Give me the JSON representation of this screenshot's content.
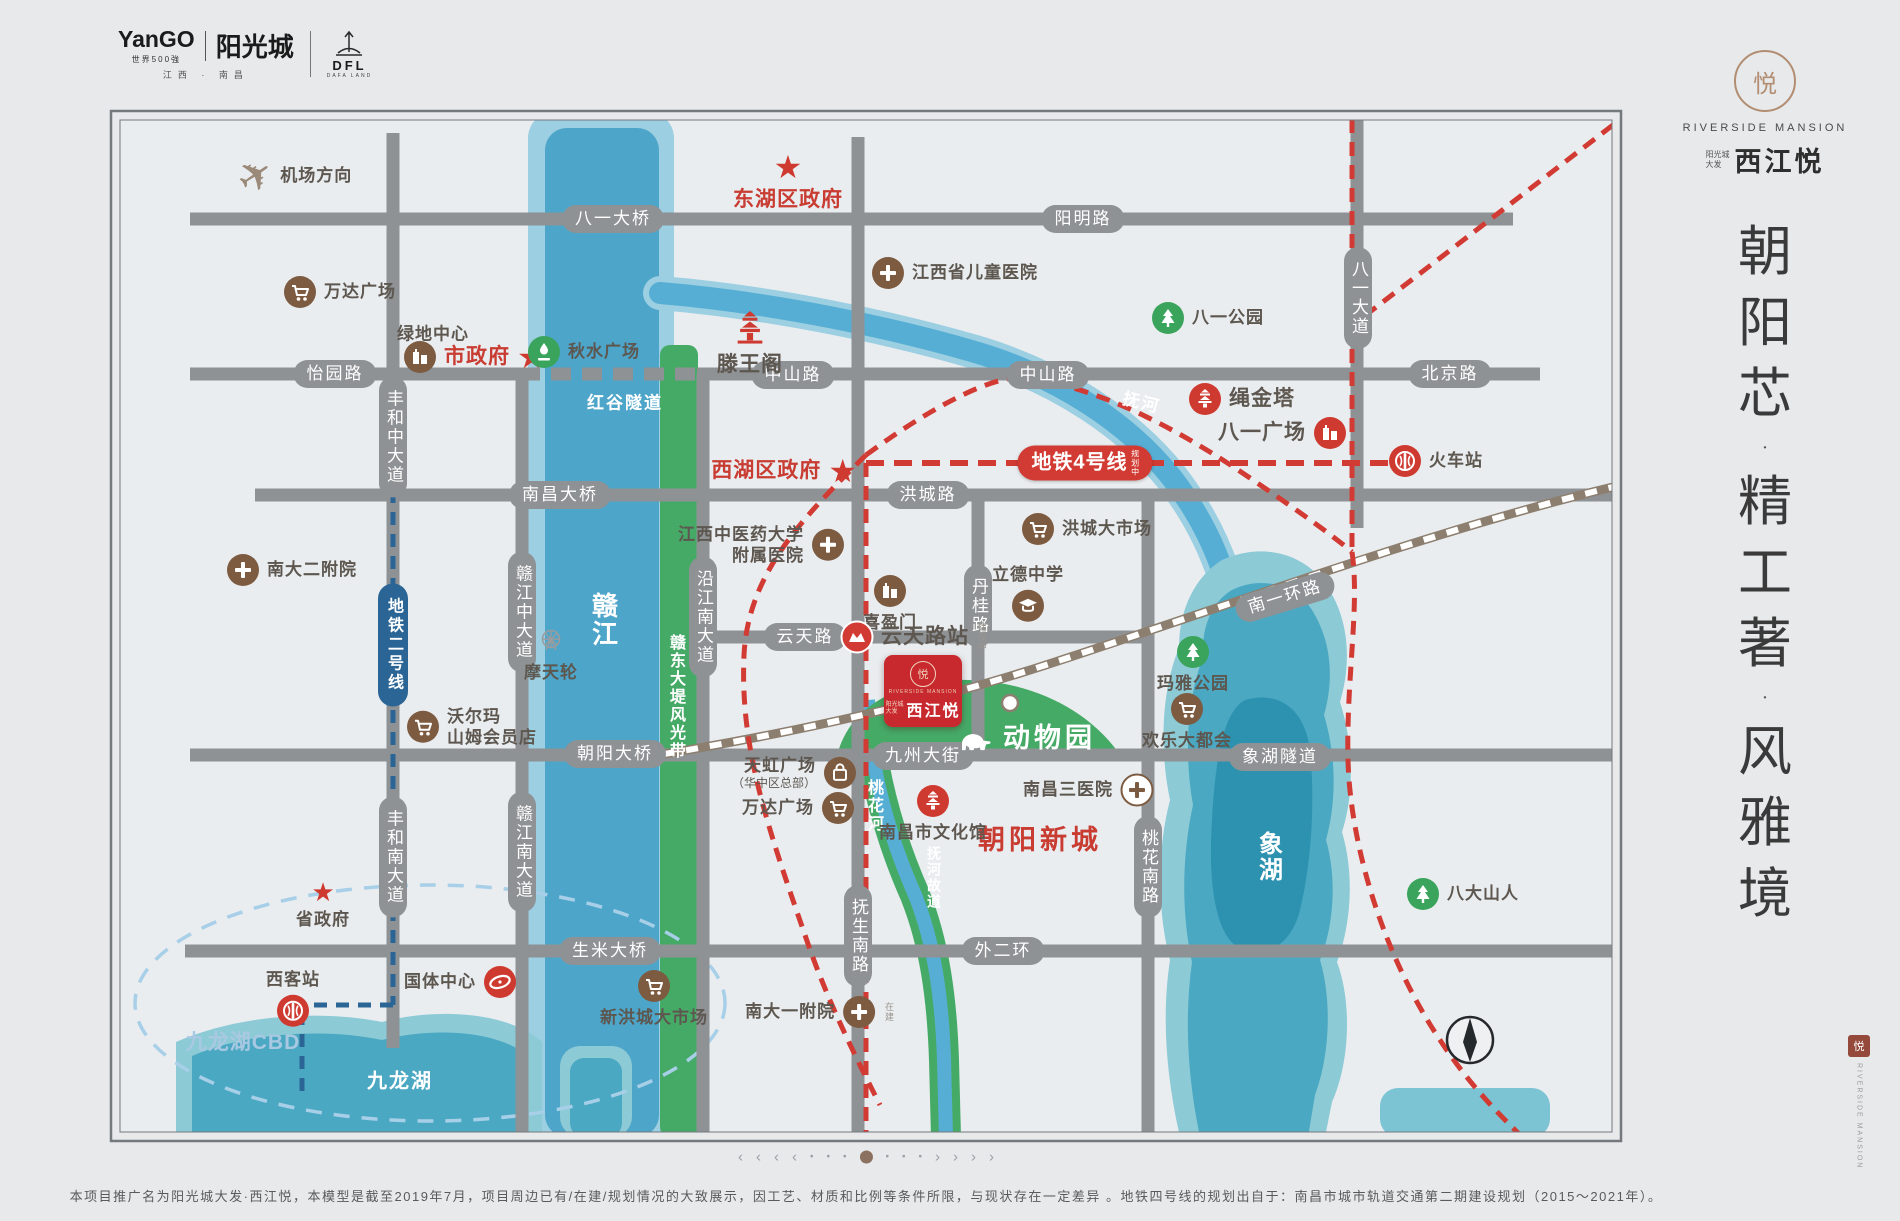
{
  "header": {
    "yango": "YanGO",
    "yango_sub": "世界500強",
    "yango_cn": "阳光城",
    "region": "江西 · 南昌",
    "dfl": "DFL",
    "dfl_sub": "DAFA LAND"
  },
  "brand": {
    "mark": "悦",
    "en": "RIVERSIDE MANSION",
    "pre1": "阳光城",
    "pre2": "大发",
    "cn": "西江悦",
    "slogan": "朝阳芯·精工著·风雅境",
    "seal": "悦",
    "seal_en": "RIVERSIDE MANSION"
  },
  "map": {
    "road_labels": [
      {
        "t": "八一大桥",
        "x": 613,
        "y": 219
      },
      {
        "t": "阳明路",
        "x": 1083,
        "y": 219
      },
      {
        "t": "怡园路",
        "x": 335,
        "y": 374
      },
      {
        "t": "中山路",
        "x": 793,
        "y": 375
      },
      {
        "t": "中山路",
        "x": 1048,
        "y": 375
      },
      {
        "t": "北京路",
        "x": 1450,
        "y": 374
      },
      {
        "t": "南昌大桥",
        "x": 560,
        "y": 495
      },
      {
        "t": "洪城路",
        "x": 928,
        "y": 495
      },
      {
        "t": "云天路",
        "x": 805,
        "y": 637
      },
      {
        "t": "朝阳大桥",
        "x": 615,
        "y": 754
      },
      {
        "t": "九州大街",
        "x": 923,
        "y": 756
      },
      {
        "t": "象湖隧道",
        "x": 1280,
        "y": 757
      },
      {
        "t": "生米大桥",
        "x": 610,
        "y": 951
      },
      {
        "t": "外二环",
        "x": 1003,
        "y": 951
      },
      {
        "t": "丰和中大道",
        "x": 393,
        "y": 437,
        "v": 1
      },
      {
        "t": "丰和南大道",
        "x": 393,
        "y": 857,
        "v": 1
      },
      {
        "t": "赣江中大道",
        "x": 522,
        "y": 612,
        "v": 1
      },
      {
        "t": "赣江南大道",
        "x": 522,
        "y": 852,
        "v": 1
      },
      {
        "t": "沿江南大道",
        "x": 703,
        "y": 617,
        "v": 1
      },
      {
        "t": "丹桂路",
        "x": 978,
        "y": 606,
        "v": 1
      },
      {
        "t": "八一大道",
        "x": 1358,
        "y": 298,
        "v": 1
      },
      {
        "t": "抚生南路",
        "x": 858,
        "y": 936,
        "v": 1
      },
      {
        "t": "桃花南路",
        "x": 1148,
        "y": 867,
        "v": 1
      },
      {
        "t": "南一环路",
        "x": 1285,
        "y": 597,
        "rot": 1
      }
    ],
    "water_labels": [
      {
        "t": "赣江",
        "x": 604,
        "y": 620,
        "v": 1,
        "f": 26
      },
      {
        "t": "赣东大堤风光带",
        "x": 675,
        "y": 697,
        "v": 1,
        "f": 16
      },
      {
        "t": "红谷隧道",
        "x": 625,
        "y": 401,
        "f": 17
      },
      {
        "t": "抚河",
        "x": 1142,
        "y": 401,
        "r": 14,
        "f": 17
      },
      {
        "t": "桃花河",
        "x": 873,
        "y": 806,
        "v": 1,
        "f": 16
      },
      {
        "t": "抚河故道",
        "x": 934,
        "y": 878,
        "v": 1,
        "f": 14
      },
      {
        "t": "象湖",
        "x": 1268,
        "y": 857,
        "v": 1,
        "f": 24
      },
      {
        "t": "九龙湖",
        "x": 400,
        "y": 1079,
        "f": 20
      }
    ],
    "metro_badges": [
      {
        "t": "地铁4号线",
        "tiny": "规划中",
        "x": 1085,
        "y": 463,
        "cls": "m4"
      },
      {
        "t": "地铁二号线",
        "x": 393,
        "y": 645,
        "cls": "m2"
      }
    ],
    "pois": [
      {
        "n": "airport-direction",
        "i": "plane",
        "x": 255,
        "y": 176,
        "l": "机场方向",
        "s": "r",
        "c": "dark"
      },
      {
        "n": "wanda-plaza-north",
        "i": "cart",
        "x": 300,
        "y": 292,
        "l": "万达广场",
        "s": "r",
        "c": "dark"
      },
      {
        "n": "greenland-center",
        "i": "none",
        "x": 433,
        "y": 334,
        "l": "绿地中心",
        "s": "t",
        "c": "dark"
      },
      {
        "n": "city-government",
        "i": "building",
        "x": 420,
        "y": 357,
        "l": "市政府",
        "s": "r",
        "c": "red",
        "star": 1,
        "big": 1
      },
      {
        "n": "qiushui-square",
        "i": "fountain",
        "x": 544,
        "y": 352,
        "l": "秋水广场",
        "s": "r",
        "c": "dark"
      },
      {
        "n": "donghu-district-government",
        "i": "star",
        "x": 788,
        "y": 168,
        "l": "东湖区政府",
        "s": "b",
        "c": "red",
        "big": 1
      },
      {
        "n": "tengwang-pavilion",
        "i": "pagoda-plain",
        "x": 750,
        "y": 323,
        "l": "滕王阁",
        "s": "b",
        "c": "dark",
        "big": 1
      },
      {
        "n": "jiangxi-children-hospital",
        "i": "cross",
        "x": 888,
        "y": 273,
        "l": "江西省儿童医院",
        "s": "r",
        "c": "dark"
      },
      {
        "n": "bayi-park",
        "i": "tree",
        "x": 1168,
        "y": 318,
        "l": "八一公园",
        "s": "r",
        "c": "dark"
      },
      {
        "n": "shengjin-tower",
        "i": "pagoda",
        "x": 1205,
        "y": 399,
        "l": "绳金塔",
        "s": "r",
        "c": "dark",
        "big": 1
      },
      {
        "n": "bayi-square",
        "i": "building-red",
        "x": 1330,
        "y": 433,
        "l": "八一广场",
        "s": "l",
        "c": "dark",
        "big": 1
      },
      {
        "n": "railway-station",
        "i": "rail",
        "x": 1405,
        "y": 461,
        "l": "火车站",
        "s": "r",
        "c": "dark"
      },
      {
        "n": "walmart-sams-club",
        "i": "cart",
        "x": 423,
        "y": 727,
        "l": "沃尔玛",
        "l2": "山姆会员店",
        "s": "r",
        "c": "dark"
      },
      {
        "n": "nanda-2nd-hospital",
        "i": "cross",
        "x": 243,
        "y": 570,
        "l": "南大二附院",
        "s": "r",
        "c": "dark"
      },
      {
        "n": "ferris-wheel",
        "i": "ferris",
        "x": 551,
        "y": 641,
        "l": "摩天轮",
        "s": "b",
        "c": "dark"
      },
      {
        "n": "provincial-government",
        "i": "star",
        "x": 323,
        "y": 896,
        "l": "省政府",
        "s": "b",
        "c": "dark"
      },
      {
        "n": "guoti-center",
        "i": "stadium",
        "x": 500,
        "y": 982,
        "l": "国体中心",
        "s": "l",
        "c": "dark"
      },
      {
        "n": "west-railway-station",
        "i": "rail",
        "x": 293,
        "y": 1011,
        "l": "西客站",
        "s": "t2",
        "c": "dark"
      },
      {
        "n": "jiulonghu-cbd",
        "i": "none",
        "x": 243,
        "y": 1043,
        "l": "九龙湖CBD",
        "s": "t",
        "c": "lblue",
        "big": 1
      },
      {
        "n": "xihu-district-government",
        "i": "star",
        "x": 840,
        "y": 471,
        "l": "西湖区政府",
        "s": "l",
        "c": "red",
        "big": 1
      },
      {
        "n": "zhongyiyao-affiliated-hospital",
        "i": "cross",
        "x": 828,
        "y": 545,
        "l": "江西中医药大学",
        "l2": "附属医院",
        "s": "l",
        "c": "dark"
      },
      {
        "n": "xiyingmen",
        "i": "building",
        "x": 890,
        "y": 591,
        "l": "喜盈门",
        "s": "b",
        "c": "dark"
      },
      {
        "n": "yuntian-road-station",
        "i": "metro",
        "x": 857,
        "y": 637,
        "l": "云天路站",
        "s": "r",
        "c": "dark",
        "big": 1,
        "tiny": "建设中"
      },
      {
        "n": "lide-middle-school",
        "i": "grad",
        "x": 1028,
        "y": 606,
        "l": "立德中学",
        "s": "t2",
        "c": "dark"
      },
      {
        "n": "hongcheng-market",
        "i": "cart",
        "x": 1038,
        "y": 529,
        "l": "洪城大市场",
        "s": "r",
        "c": "dark"
      },
      {
        "n": "maya-park",
        "i": "tree",
        "x": 1193,
        "y": 652,
        "l": "玛雅公园",
        "s": "b",
        "c": "dark"
      },
      {
        "n": "happy-metropolis",
        "i": "cart",
        "x": 1187,
        "y": 709,
        "l": "欢乐大都会",
        "s": "b",
        "c": "dark"
      },
      {
        "n": "nanchang-3rd-hospital",
        "i": "cross-wb",
        "x": 1137,
        "y": 790,
        "l": "南昌三医院",
        "s": "l",
        "c": "dark"
      },
      {
        "n": "chaoyang-new-town",
        "i": "none",
        "x": 1040,
        "y": 841,
        "l": "朝阳新城",
        "s": "t",
        "c": "red",
        "huge": 1
      },
      {
        "n": "nanchang-culture-center",
        "i": "pagoda",
        "x": 933,
        "y": 801,
        "l": "南昌市文化馆",
        "s": "b",
        "c": "dark"
      },
      {
        "n": "rainbow-plaza",
        "i": "bag",
        "x": 840,
        "y": 773,
        "l": "天虹广场",
        "l2": "（华中区总部）",
        "s": "l",
        "c": "dark",
        "sub": 1
      },
      {
        "n": "wanda-plaza-south",
        "i": "cart",
        "x": 838,
        "y": 808,
        "l": "万达广场",
        "s": "l",
        "c": "dark"
      },
      {
        "n": "new-hongcheng-market",
        "i": "cart",
        "x": 654,
        "y": 986,
        "l": "新洪城大市场",
        "s": "b",
        "c": "dark"
      },
      {
        "n": "nanda-1st-hospital",
        "i": "cross",
        "x": 876,
        "y": 1012,
        "l": "南大一附院",
        "s": "l",
        "c": "dark",
        "tiny": "在建"
      },
      {
        "n": "badashanren",
        "i": "tree",
        "x": 1423,
        "y": 894,
        "l": "八大山人",
        "s": "r",
        "c": "dark"
      },
      {
        "n": "zoo",
        "i": "elephant",
        "x": 973,
        "y": 739,
        "l": "动物园",
        "s": "r",
        "c": "white",
        "huge": 1
      }
    ],
    "project": {
      "ch": "悦",
      "en": "RIVERSIDE MANSION",
      "pre1": "阳光城",
      "pre2": "大发",
      "cn": "西江悦"
    }
  },
  "footer": {
    "pagination": [
      "‹",
      "‹",
      "‹",
      "‹",
      "•",
      "•",
      "•",
      "◉",
      "•",
      "•",
      "•",
      "›",
      "›",
      "›",
      "›"
    ],
    "disclaimer": "本项目推广名为阳光城大发·西江悦，本模型是截至2019年7月，项目周边已有/在建/规划情况的大致展示，因工艺、材质和比例等条件所限，与现状存在一定差异 。地铁四号线的规划出自于：南昌市城市轨道交通第二期建设规划（2015～2021年）。"
  }
}
